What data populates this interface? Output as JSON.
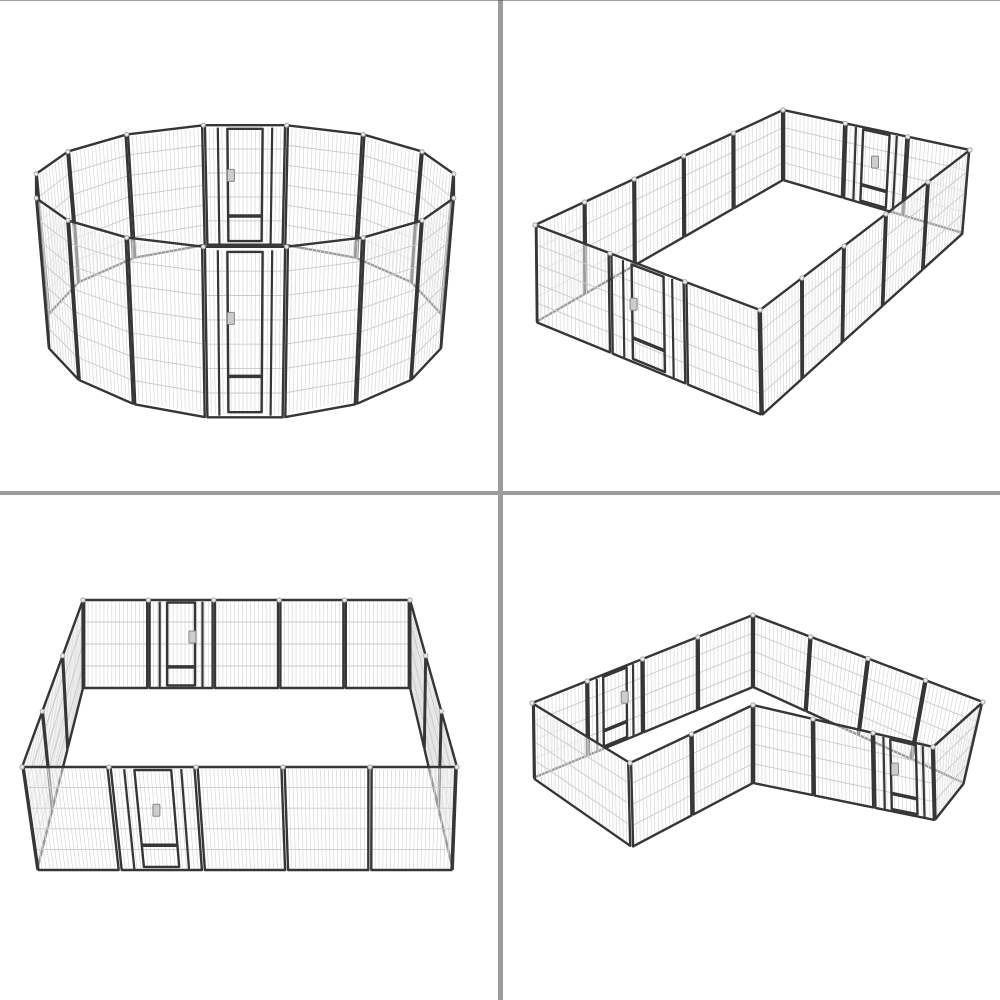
{
  "meta": {
    "description": "Product image collage: heavy-duty 16-panel metal dog playpen shown in four layout configurations",
    "background_color": "#ffffff",
    "top_edge_line_color": "#4f4f4f"
  },
  "grid": {
    "divider_color": "#9c9c9c",
    "vertical_divider_x": 498,
    "vertical_divider_width": 5,
    "horizontal_divider_y": 491,
    "horizontal_divider_height": 4
  },
  "product": {
    "panels_total": 16,
    "gates_per_layout": 2,
    "frame_color": "#363636",
    "mesh_vertical_wire_color": "#dcdcdc",
    "mesh_horizontal_wire_color": "#c9c9c9",
    "panel_fill": "#ffffff",
    "connector_pin_color": "#ececec",
    "connector_pin_border": "#a9a9a9",
    "latch_color": "#cdcdcd",
    "latch_border": "#888888",
    "views": [
      {
        "id": "ring",
        "position": "top-left",
        "label": "Playpen arranged in a circle - 16 metal mesh panels with front and rear gates"
      },
      {
        "id": "rectangle",
        "position": "top-right",
        "label": "Playpen arranged as a long rectangle - 16 metal mesh panels with two gates"
      },
      {
        "id": "square",
        "position": "bottom-left",
        "label": "Playpen arranged as a wide square - 16 metal mesh panels with front and rear gates"
      },
      {
        "id": "l_shape",
        "position": "bottom-right",
        "label": "Playpen arranged in an L shape - 16 metal mesh panels with two gates"
      }
    ]
  }
}
